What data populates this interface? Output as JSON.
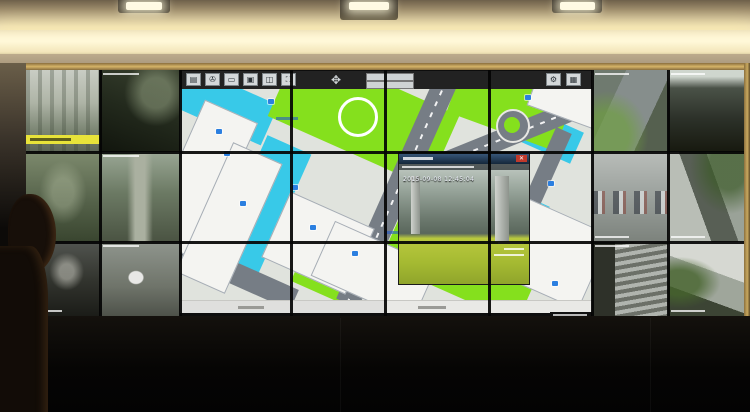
{
  "map_toolbar": {
    "buttons": [
      {
        "name": "layers-tool",
        "glyph": "▤"
      },
      {
        "name": "rotate-tool",
        "glyph": "✇"
      },
      {
        "name": "measure-tool",
        "glyph": "▭"
      },
      {
        "name": "camera-tool",
        "glyph": "▣"
      },
      {
        "name": "split-view-tool",
        "glyph": "◫"
      },
      {
        "name": "fullscreen-tool",
        "glyph": "⛶"
      }
    ],
    "dpad_glyph": "✥",
    "right_buttons": [
      {
        "name": "settings-tool",
        "glyph": "⚙"
      },
      {
        "name": "grid-tool",
        "glyph": "▦"
      }
    ]
  },
  "popup": {
    "timestamp": "2015-09-08 12:45:04",
    "close_glyph": "✕"
  },
  "colors": {
    "map_water": "#38c9e8",
    "map_lawn": "#85e01d",
    "map_road": "#767d85",
    "alert_highlight": "#e8e33a",
    "close_red": "#c0392b"
  }
}
